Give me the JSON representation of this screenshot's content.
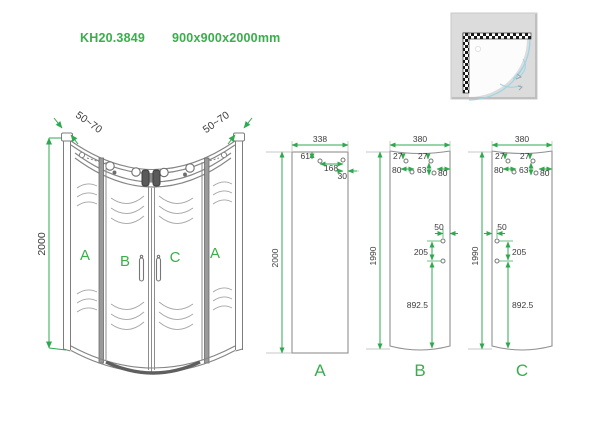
{
  "colors": {
    "accent_green": "#3aae4b",
    "line_gray": "#8d8d8d",
    "dark_line": "#555555",
    "dim_text": "#3b3b3b",
    "icon_bg": "#dcdcdc",
    "icon_blue": "#9fd4e4"
  },
  "header": {
    "model": "KH20.3849",
    "dimensions": "900x900x2000mm"
  },
  "main_view": {
    "height_dim": "2000",
    "left_adjust_dim": "50~70",
    "right_adjust_dim": "50~70",
    "labels": {
      "fixed_left": "A",
      "door_left": "B",
      "door_right": "C",
      "fixed_right": "A"
    }
  },
  "panel_details": {
    "a": {
      "label": "A",
      "width": "338",
      "height": "2000",
      "hole_top_offset": "61",
      "hole_spacing": "168",
      "hole_edge_offset": "30"
    },
    "b": {
      "label": "B",
      "width": "380",
      "height": "1990",
      "top_offset_left": "27",
      "edge_offset_left": "80",
      "top_offset_right": "27",
      "drop_right": "63",
      "edge_offset_right": "80",
      "handle_edge_offset": "50",
      "handle_spacing": "205",
      "handle_bottom": "892.5"
    },
    "c": {
      "label": "C",
      "width": "380",
      "height": "1990",
      "top_offset_left": "27",
      "edge_offset_left": "80",
      "top_offset_right": "27",
      "drop_right": "63",
      "edge_offset_right": "80",
      "handle_edge_offset": "50",
      "handle_spacing": "205",
      "handle_bottom": "892.5"
    }
  }
}
